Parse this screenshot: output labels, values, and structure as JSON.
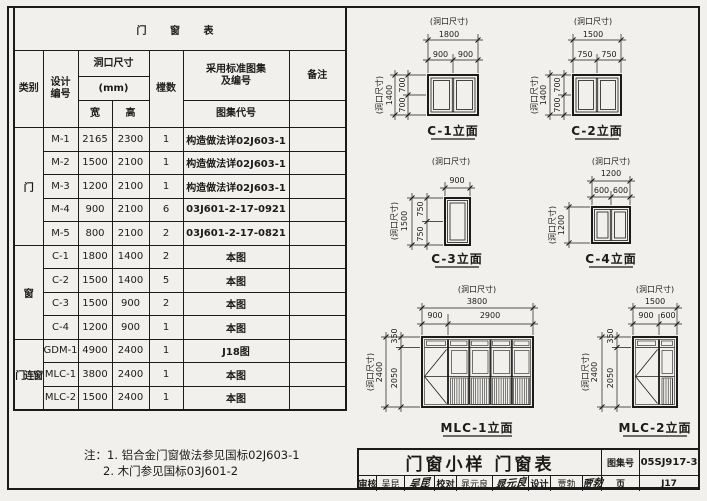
{
  "colors": {
    "paper": "#f1f0ec",
    "line": "#1b1b1b"
  },
  "table": {
    "title": "门 窗 表",
    "col_category": "类别",
    "col_design_no": [
      "设计",
      "编号"
    ],
    "col_opening": "洞口尺寸",
    "col_unit": "(mm)",
    "col_width": "宽",
    "col_height": "高",
    "col_count": "樘数",
    "col_standard_1": "采用标准图集",
    "col_standard_2": "及编号",
    "col_atlas_code": "图集代号",
    "col_remark": "备注",
    "categories": {
      "door": "门",
      "window": "窗",
      "door_window": "门连窗"
    },
    "rows": [
      {
        "no": "M-1",
        "w": "2165",
        "h": "2300",
        "count": "1",
        "ref": "构造做法详02J603-1"
      },
      {
        "no": "M-2",
        "w": "1500",
        "h": "2100",
        "count": "1",
        "ref": "构造做法详02J603-1"
      },
      {
        "no": "M-3",
        "w": "1200",
        "h": "2100",
        "count": "1",
        "ref": "构造做法详02J603-1"
      },
      {
        "no": "M-4",
        "w": "900",
        "h": "2100",
        "count": "6",
        "ref": "03J601-2-17-0921"
      },
      {
        "no": "M-5",
        "w": "800",
        "h": "2100",
        "count": "2",
        "ref": "03J601-2-17-0821"
      },
      {
        "no": "C-1",
        "w": "1800",
        "h": "1400",
        "count": "2",
        "ref": "本图"
      },
      {
        "no": "C-2",
        "w": "1500",
        "h": "1400",
        "count": "5",
        "ref": "本图"
      },
      {
        "no": "C-3",
        "w": "1500",
        "h": "900",
        "count": "2",
        "ref": "本图"
      },
      {
        "no": "C-4",
        "w": "1200",
        "h": "900",
        "count": "1",
        "ref": "本图"
      },
      {
        "no": "GDM-1",
        "w": "4900",
        "h": "2400",
        "count": "1",
        "ref": "J18图"
      },
      {
        "no": "MLC-1",
        "w": "3800",
        "h": "2400",
        "count": "1",
        "ref": "本图"
      },
      {
        "no": "MLC-2",
        "w": "1500",
        "h": "2400",
        "count": "1",
        "ref": "本图"
      }
    ],
    "note_line1": "注：1. 铝合金门窗做法参见国标02J603-1",
    "note_line2": "2. 木门参见国标03J601-2"
  },
  "elevations": {
    "dim_label": "(洞口尺寸)",
    "c1": {
      "label": "C-1立面",
      "total_w": "1800",
      "part_w1": "900",
      "part_w2": "900",
      "total_h": "1400",
      "part_h1": "700",
      "part_h2": "700"
    },
    "c2": {
      "label": "C-2立面",
      "total_w": "1500",
      "part_w1": "750",
      "part_w2": "750",
      "total_h": "1400",
      "part_h1": "700",
      "part_h2": "700"
    },
    "c3": {
      "label": "C-3立面",
      "total_w": "900",
      "total_h": "1500",
      "part_h1": "750",
      "part_h2": "750"
    },
    "c4": {
      "label": "C-4立面",
      "total_w": "1200",
      "part_w1": "600",
      "part_w2": "600",
      "total_h": "1200"
    },
    "mlc1": {
      "label": "MLC-1立面",
      "total_w": "3800",
      "part_w1": "900",
      "part_w2": "2900",
      "total_h": "2400",
      "part_h1": "350",
      "part_h2": "2050"
    },
    "mlc2": {
      "label": "MLC-2立面",
      "total_w": "1500",
      "part_w1": "900",
      "part_w2": "600",
      "total_h": "2400",
      "part_h1": "350",
      "part_h2": "2050"
    }
  },
  "title_block": {
    "title": "门窗小样  门窗表",
    "atlas_label": "图集号",
    "atlas_no": "05SJ917-3",
    "page_label": "页",
    "page_no": "J17",
    "reviewer_label": "审核",
    "reviewer_name": "吴昆",
    "reviewer_sig": "吴昆",
    "checker_label": "校对",
    "checker_name": "晁元良",
    "checker_sig": "晁元良",
    "designer_label": "设计",
    "designer_name": "贾勃",
    "designer_sig": "贾勃"
  }
}
